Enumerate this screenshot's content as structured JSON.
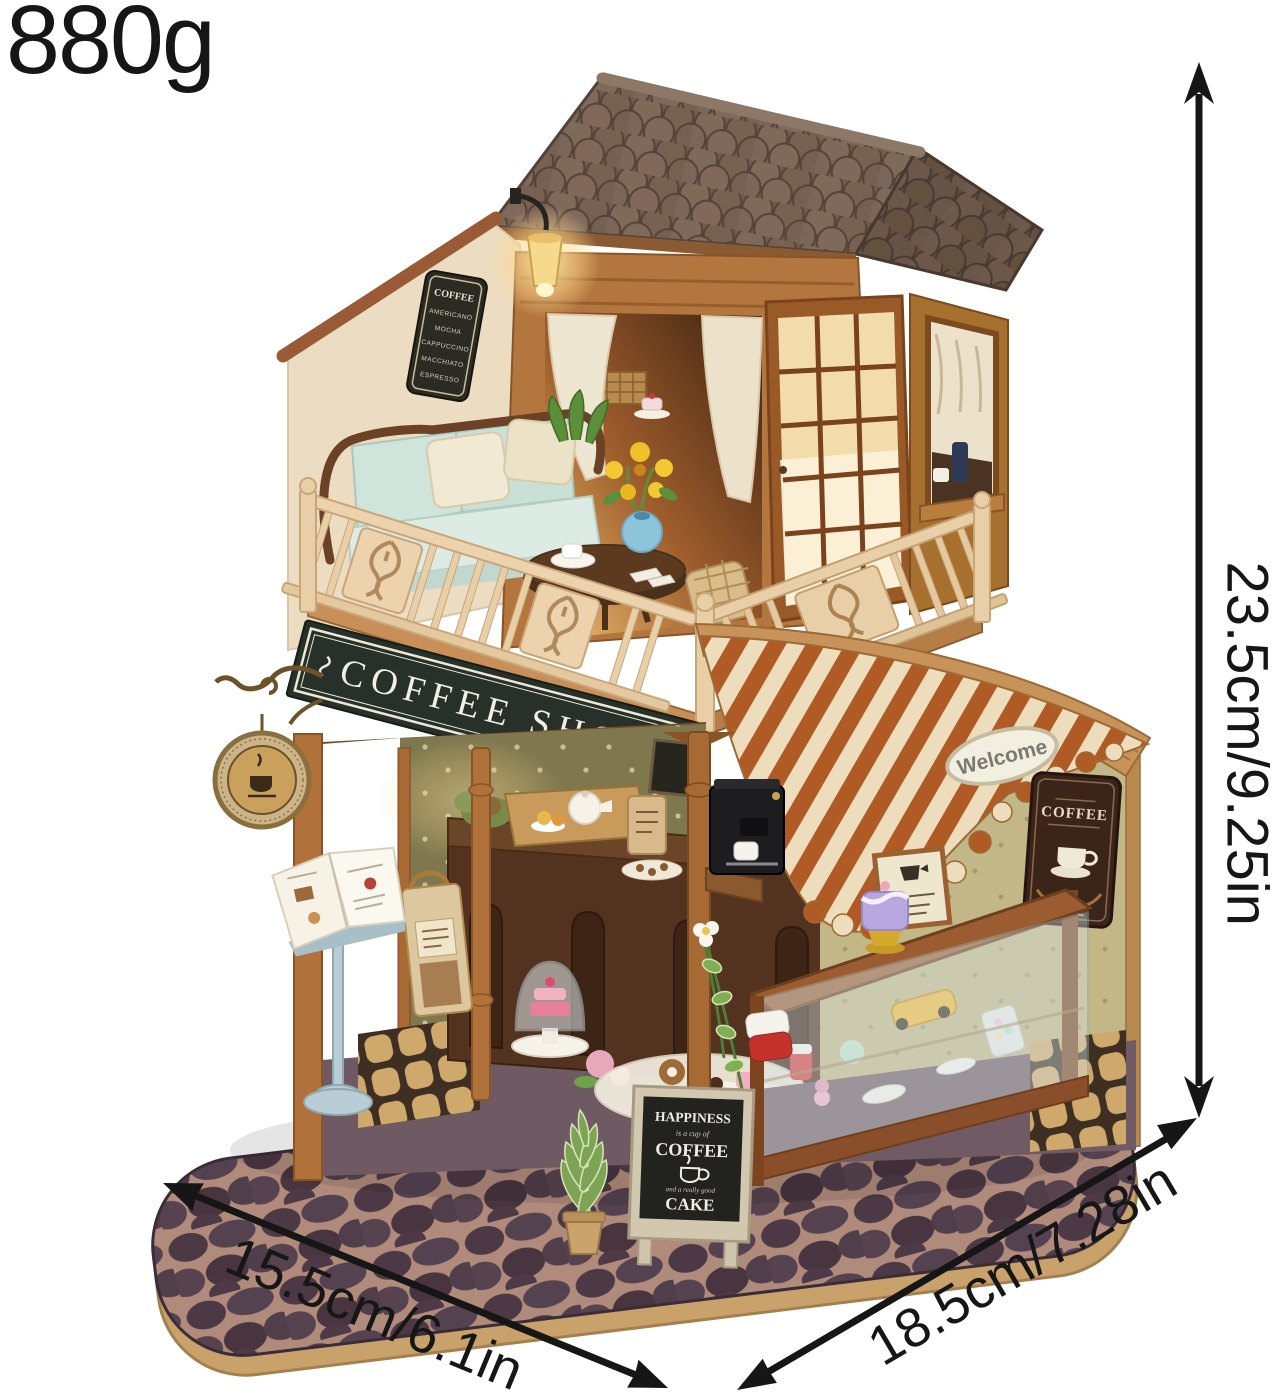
{
  "page": {
    "background": "#ffffff",
    "type": "product-photo",
    "subject": "DIY miniature coffee shop dollhouse kit shown with weight and dimension annotations"
  },
  "annotations": {
    "weight": "880g",
    "height": "23.5cm/9.25in",
    "width": "15.5cm/6.1in",
    "depth": "18.5cm/7.28in",
    "text_color": "#161616",
    "arrow_color": "#161616"
  },
  "signs": {
    "shop": "COFFEE SHOP",
    "menu": {
      "title": "COFFEE",
      "items": [
        "AMERICANO",
        "MOCHA",
        "CAPPUCCINO",
        "MACCHIATO",
        "ESPRESSO"
      ]
    },
    "chalkboard": {
      "line1": "HAPPINESS",
      "script1": "is a cup of",
      "line2": "COFFEE",
      "script2": "and a really good",
      "line3": "CAKE"
    },
    "awning_sticker": "Welcome",
    "wall_sign": "COFFEE"
  },
  "colors": {
    "roof_shingle": "#6f5c4c",
    "wood": "#b0713a",
    "wood_dark": "#7c4a24",
    "gable": "#ecdcc2",
    "railing": "#ecd3ae",
    "sign_board": "#27312a",
    "sign_text": "#f2efe4",
    "awning_rust": "#b05a25",
    "awning_cream": "#eeddbd",
    "wall_olive": "#c3b687",
    "interior_olive": "#7f784e",
    "counter": "#533320",
    "base_cobble": "#4a3742",
    "base_rim": "#c9a16b",
    "lamp_glow": "#f7cf8a",
    "sofa_mint": "#cfe4da",
    "vase_blue": "#8cc4da",
    "lectern_blue": "#b9cdd6",
    "chalkboard": "#22221e"
  }
}
